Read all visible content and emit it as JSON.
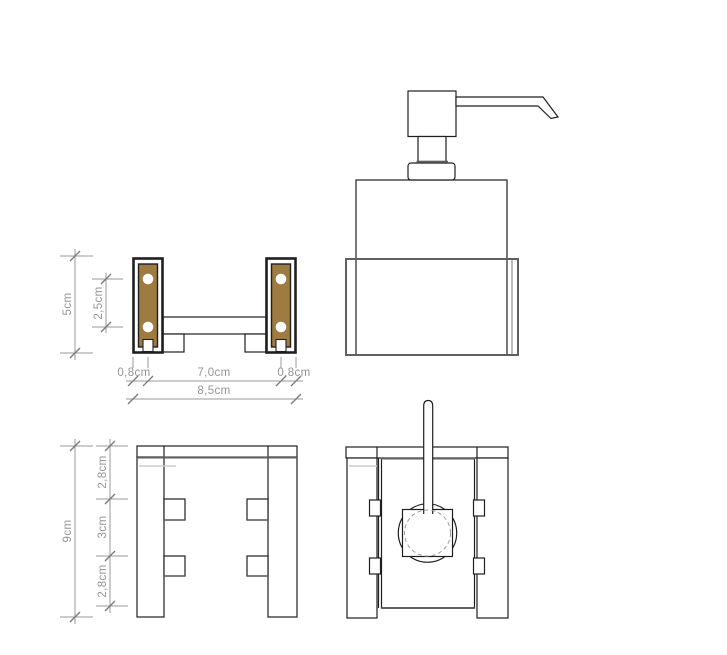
{
  "colors": {
    "background": "#ffffff",
    "line": "#1f1f1f",
    "thick_line": "#5f5f5f",
    "dim_line": "#9a9a9a",
    "dim_tick": "#7a7a7a",
    "dim_text": "#949494",
    "brass": "#9d7b41",
    "faint_line": "#cccccc",
    "dashed": "#9a9a9a"
  },
  "dimensions": {
    "bracket_front": {
      "height": "5cm",
      "hole_spacing": "2,5cm",
      "left_plate": "0,8cm",
      "span": "7,0cm",
      "right_plate": "0,8cm",
      "overall_width": "8,5cm"
    },
    "holder_side": {
      "overall_depth": "9cm",
      "upper": "2,8cm",
      "middle": "3cm",
      "lower": "2,8cm"
    }
  }
}
